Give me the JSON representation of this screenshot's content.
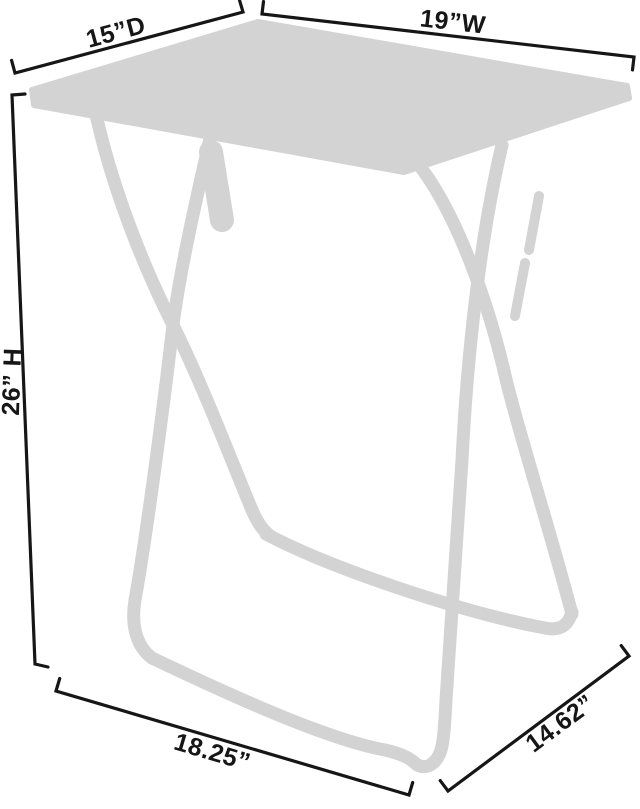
{
  "diagram": {
    "background_color": "#ffffff",
    "silhouette_color": "#d3d3d3",
    "line_color": "#161616",
    "dimensions": {
      "depth": "15”D",
      "width": "19”W",
      "height": "26” H",
      "base_width": "18.25”",
      "base_depth": "14.62”"
    }
  }
}
